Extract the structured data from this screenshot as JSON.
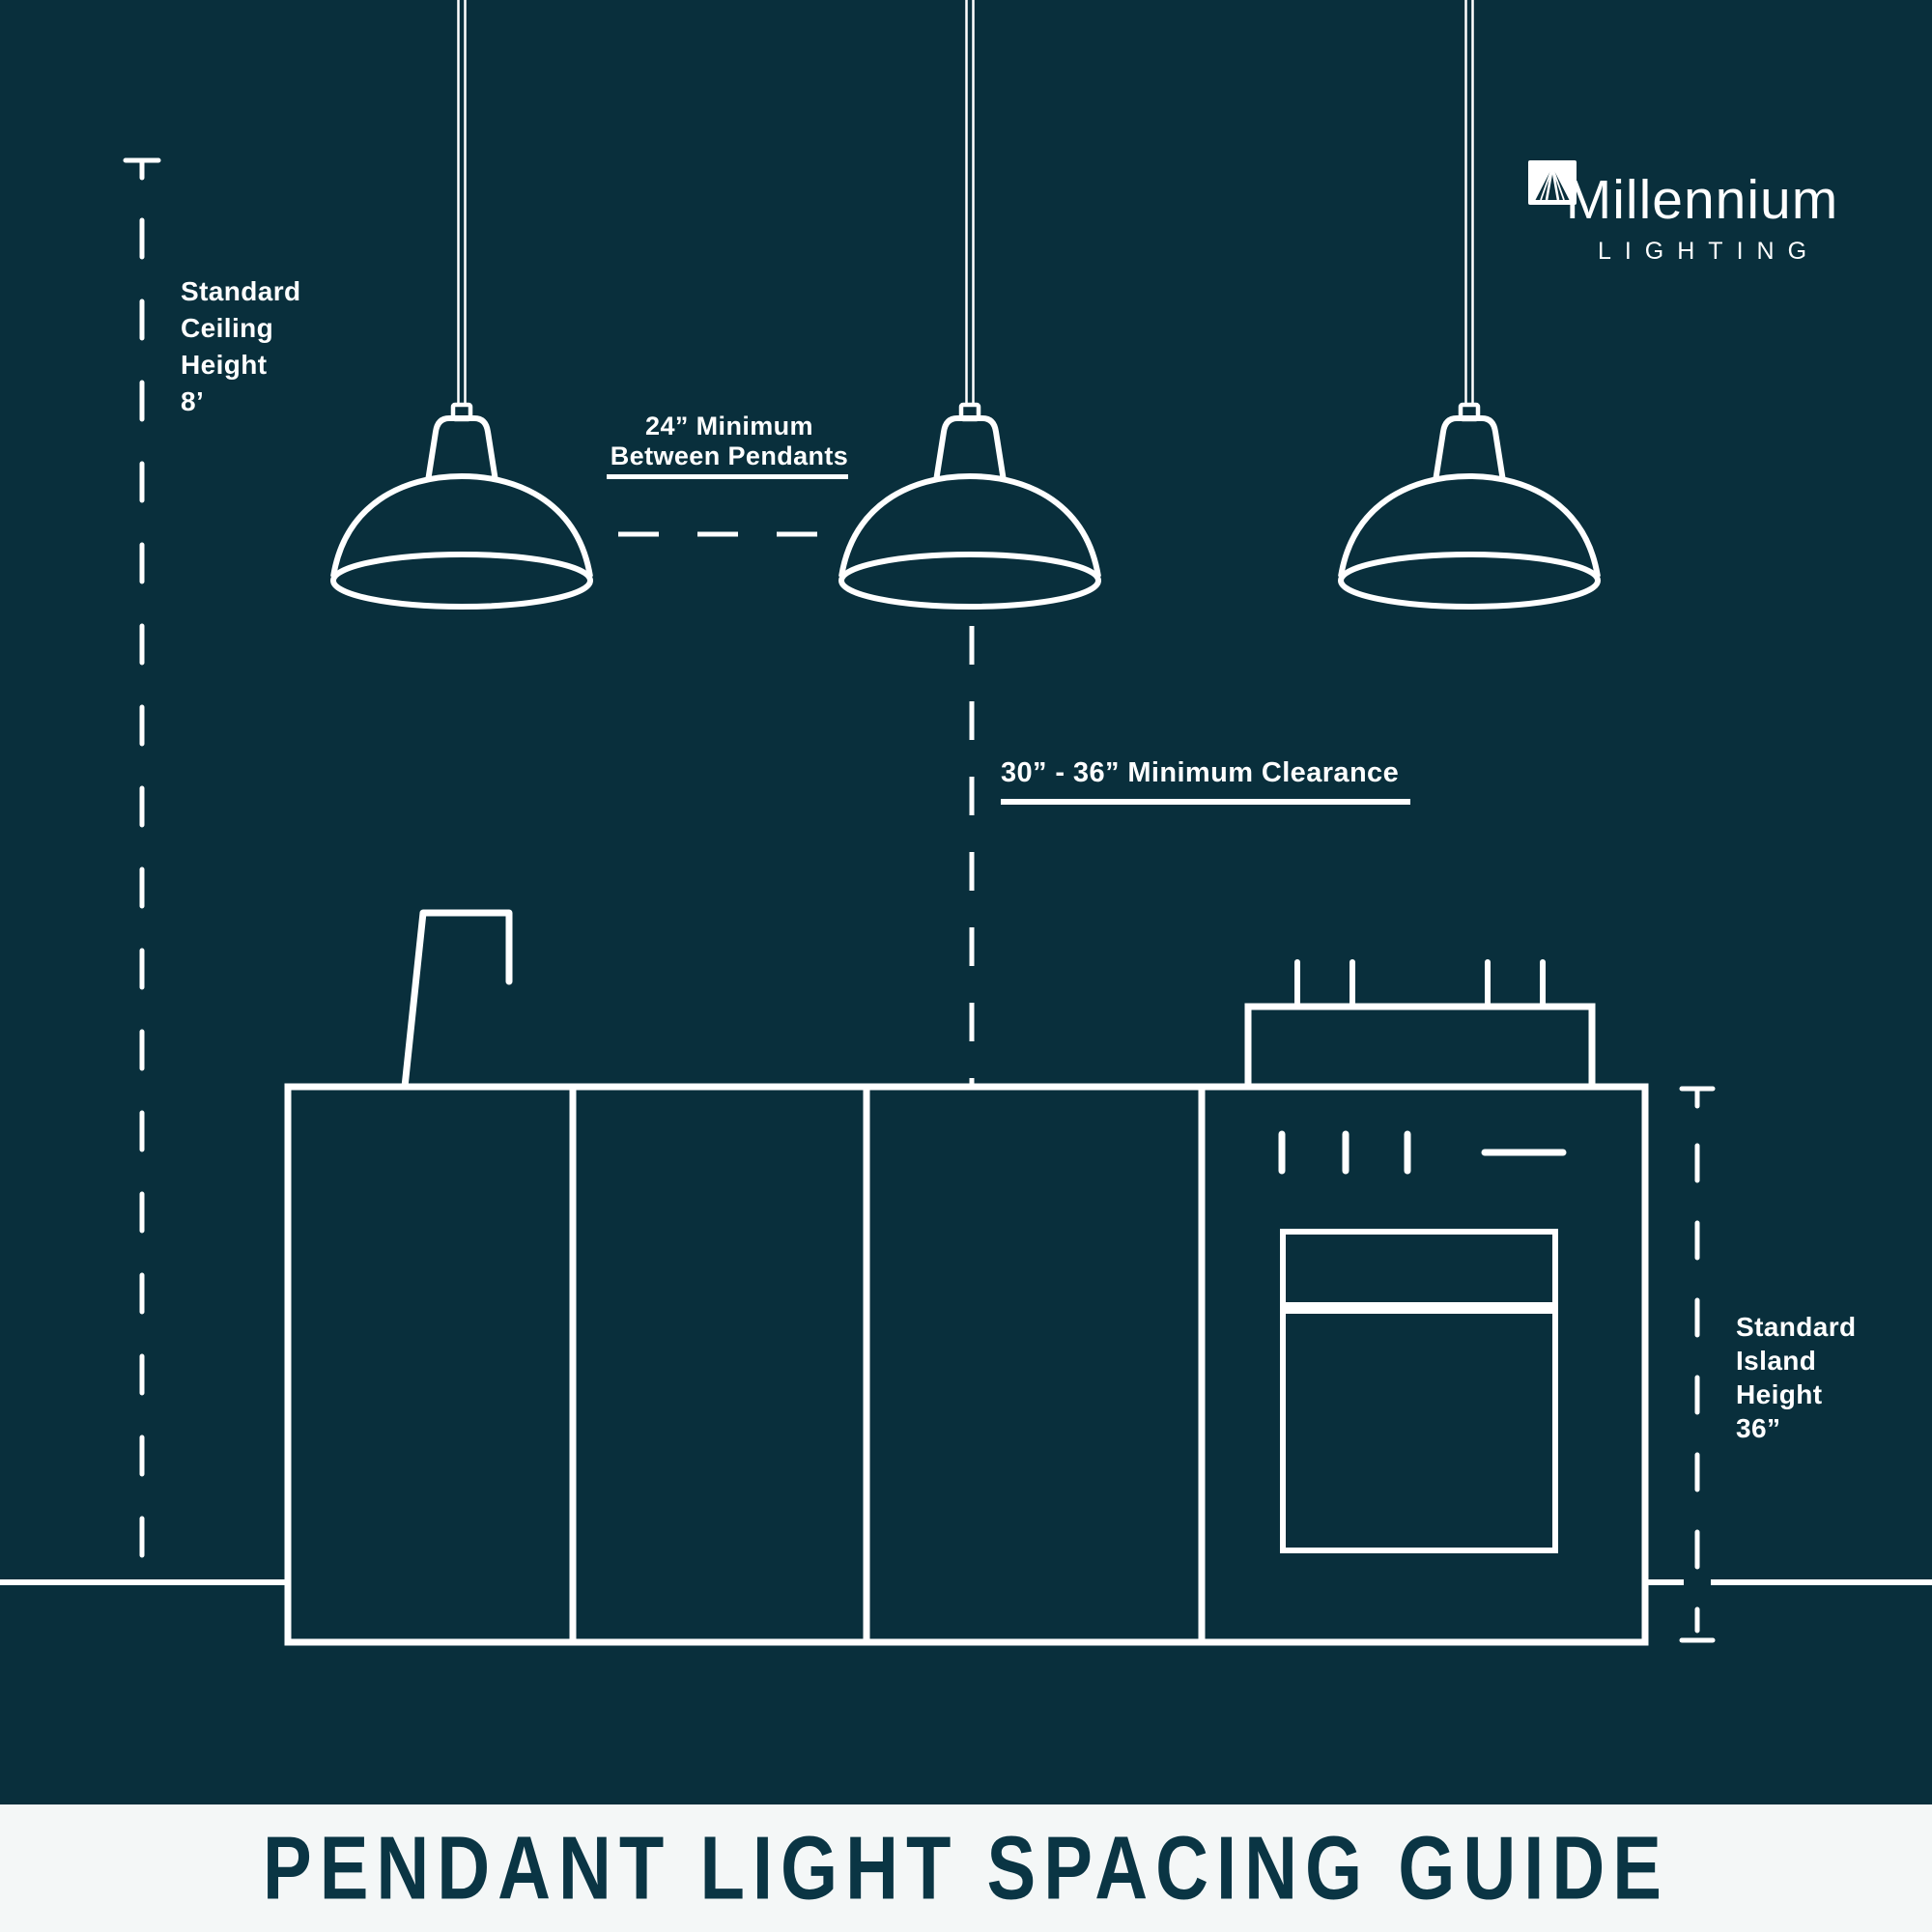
{
  "colors": {
    "background": "#092f3c",
    "line": "#ffffff",
    "footer_bg": "#f4f7f7",
    "footer_text": "#0a3544"
  },
  "logo": {
    "name": "Millennium",
    "subtitle": "LIGHTING"
  },
  "annotations": {
    "ceiling_height": {
      "lines": [
        "Standard",
        "Ceiling",
        "Height",
        "8’"
      ]
    },
    "between_pendants": {
      "lines": [
        "24” Minimum",
        "Between Pendants"
      ]
    },
    "clearance": {
      "text": "30” - 36” Minimum Clearance"
    },
    "island_height": {
      "lines": [
        "Standard",
        "Island",
        "Height",
        "36”"
      ]
    }
  },
  "footer": {
    "title": "PENDANT LIGHT SPACING GUIDE"
  }
}
